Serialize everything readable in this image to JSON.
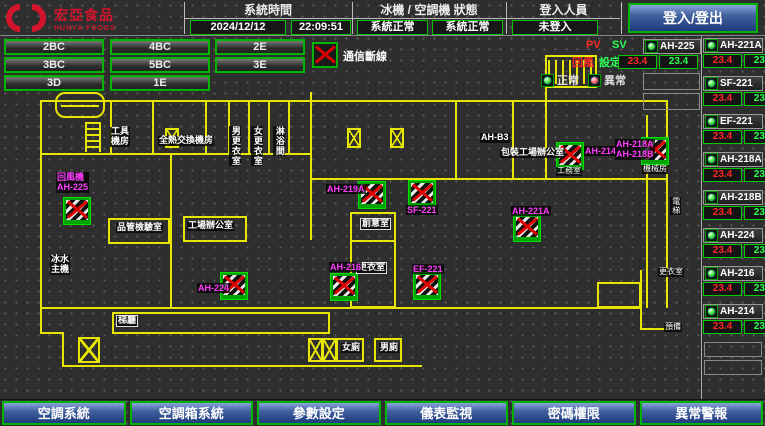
{
  "header": {
    "logo": {
      "name": "宏亞食品",
      "subtitle": "HUNYA FOODS"
    },
    "time_section": {
      "title": "系統時間",
      "date": "2024/12/12",
      "time": "22:09:51"
    },
    "status_section": {
      "title": "冰機 / 空調機 狀態",
      "chiller_status": "系統正常",
      "ahu_status": "系統正常"
    },
    "login_section": {
      "title": "登入人員",
      "user": "未登入"
    },
    "login_button": "登入/登出"
  },
  "floor_rows": [
    [
      "2BC",
      "4BC",
      "2E"
    ],
    [
      "3BC",
      "5BC",
      "3E"
    ],
    [
      "3D",
      "1E"
    ]
  ],
  "comm_legend": "通信斷線",
  "point_legend": {
    "pv": "PV",
    "sv": "SV",
    "pv_name": "回風",
    "sv_name": "設定",
    "normal": "正常",
    "abnormal": "異常"
  },
  "units_left": [
    {
      "name": "AH-225",
      "pv": "23.4",
      "sv": "23.4"
    }
  ],
  "units_right": [
    {
      "name": "AH-221A",
      "pv": "23.4",
      "sv": "23.4"
    },
    {
      "name": "SF-221",
      "pv": "23.4",
      "sv": "23.4"
    },
    {
      "name": "EF-221",
      "pv": "23.4",
      "sv": "23.4"
    },
    {
      "name": "AH-218A",
      "pv": "23.4",
      "sv": "23.4"
    },
    {
      "name": "AH-218B",
      "pv": "23.4",
      "sv": "23.4"
    },
    {
      "name": "AH-224",
      "pv": "23.4",
      "sv": "23.4"
    },
    {
      "name": "AH-216",
      "pv": "23.4",
      "sv": "23.4"
    },
    {
      "name": "AH-214",
      "pv": "23.4",
      "sv": "23.4"
    }
  ],
  "nav_buttons": [
    "空調系統",
    "空調箱系統",
    "參數設定",
    "儀表監視",
    "密碼權限",
    "異常警報"
  ],
  "colors": {
    "accent_green": "#00b400",
    "alarm_red": "#dd0000",
    "magenta": "#ff3cff",
    "wall_yellow": "#e6e600",
    "button_blue": "#31549e"
  },
  "floorplan": {
    "markers": [
      {
        "x": 63,
        "y": 161
      },
      {
        "x": 358,
        "y": 145
      },
      {
        "x": 408,
        "y": 144
      },
      {
        "x": 556,
        "y": 106
      },
      {
        "x": 641,
        "y": 101
      },
      {
        "x": 513,
        "y": 178
      },
      {
        "x": 413,
        "y": 236
      },
      {
        "x": 220,
        "y": 236
      },
      {
        "x": 330,
        "y": 237
      }
    ],
    "equipment_labels": [
      {
        "x": 56,
        "y": 136,
        "text": "回風機\nAH-225"
      },
      {
        "x": 326,
        "y": 148,
        "text": "AH-219A"
      },
      {
        "x": 406,
        "y": 169,
        "text": "SF-221"
      },
      {
        "x": 584,
        "y": 110,
        "text": "AH-214"
      },
      {
        "x": 615,
        "y": 103,
        "text": "AH-218A\nAH-218B"
      },
      {
        "x": 511,
        "y": 170,
        "text": "AH-221A"
      },
      {
        "x": 412,
        "y": 228,
        "text": "EF-221"
      },
      {
        "x": 197,
        "y": 247,
        "text": "AH-224"
      },
      {
        "x": 329,
        "y": 226,
        "text": "AH-216"
      }
    ],
    "room_labels": [
      {
        "x": 110,
        "y": 91,
        "text": "工具\n機房"
      },
      {
        "x": 158,
        "y": 100,
        "text": "全熱交換機房"
      },
      {
        "x": 229,
        "y": 90,
        "text": "男更衣室",
        "vertical": true
      },
      {
        "x": 251,
        "y": 90,
        "text": "女更衣室",
        "vertical": true
      },
      {
        "x": 273,
        "y": 90,
        "text": "淋浴間",
        "vertical": true
      },
      {
        "x": 480,
        "y": 97,
        "text": "AH-B3"
      },
      {
        "x": 500,
        "y": 112,
        "text": "包裝工場辦公室"
      },
      {
        "x": 556,
        "y": 131,
        "text": "工務室",
        "tiny": true
      },
      {
        "x": 642,
        "y": 129,
        "text": "機械房",
        "tiny": true
      },
      {
        "x": 116,
        "y": 187,
        "text": "品管檢驗室"
      },
      {
        "x": 187,
        "y": 185,
        "text": "工場辦公室"
      },
      {
        "x": 360,
        "y": 182,
        "text": "創意室",
        "boxed": true
      },
      {
        "x": 356,
        "y": 226,
        "text": "更衣室",
        "boxed": true
      },
      {
        "x": 50,
        "y": 219,
        "text": "冰水\n主機"
      },
      {
        "x": 116,
        "y": 279,
        "text": "梯廳",
        "boxed": true
      },
      {
        "x": 670,
        "y": 161,
        "text": "電梯",
        "vertical": true,
        "tiny": true
      },
      {
        "x": 658,
        "y": 232,
        "text": "更衣室",
        "tiny": true
      },
      {
        "x": 664,
        "y": 287,
        "text": "預備",
        "tiny": true
      },
      {
        "x": 341,
        "y": 307,
        "text": "女廁"
      },
      {
        "x": 379,
        "y": 307,
        "text": "男廁"
      }
    ]
  }
}
